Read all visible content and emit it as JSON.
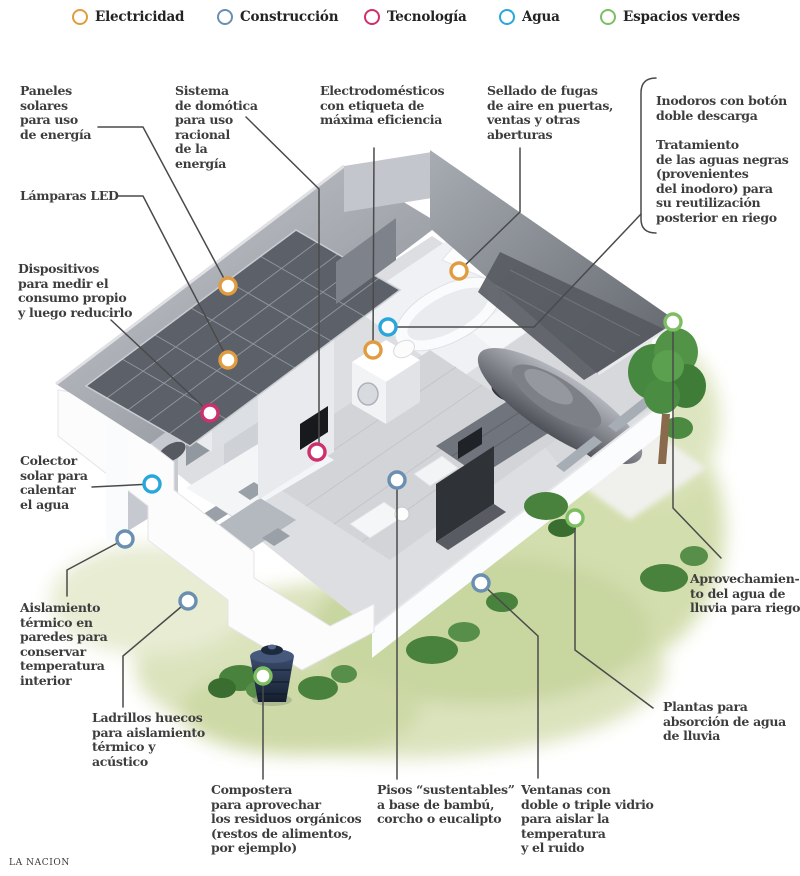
{
  "page": {
    "background": "#ffffff",
    "leader_color": "#4a4a4a",
    "text_color": "#3d3d3d"
  },
  "legend": {
    "items": [
      {
        "id": "electricidad",
        "label": "Electricidad",
        "color": "#E09C3F"
      },
      {
        "id": "construccion",
        "label": "Construcción",
        "color": "#6A8FB0"
      },
      {
        "id": "tecnologia",
        "label": "Tecnología",
        "color": "#CE2F6D"
      },
      {
        "id": "agua",
        "label": "Agua",
        "color": "#29A7DB"
      },
      {
        "id": "espacios_verdes",
        "label": "Espacios verdes",
        "color": "#7DBE63"
      }
    ]
  },
  "callouts": {
    "paneles_solares": {
      "category": "electricidad",
      "text": "Paneles\nsolares\npara uso\nde energía"
    },
    "sistema_domotica": {
      "category": "tecnologia",
      "text": "Sistema\nde domótica\npara uso\nracional\nde la\nenergía"
    },
    "electrodomesticos": {
      "category": "electricidad",
      "text": "Electrodomésticos\ncon etiqueta de\nmáxima eficiencia"
    },
    "sellado_fugas": {
      "category": "electricidad",
      "text": "Sellado de fugas\nde aire en puertas,\nventas y otras\naberturas"
    },
    "inodoros": {
      "category": "agua",
      "text": "Inodoros con botón\ndoble descarga"
    },
    "tratamiento": {
      "category": "agua",
      "text": "Tratamiento\nde las aguas negras\n(provenientes\ndel inodoro) para\nsu reutilización\nposterior en riego"
    },
    "lamparas_led": {
      "category": "electricidad",
      "text": "Lámparas LED"
    },
    "dispositivos": {
      "category": "tecnologia",
      "text": "Dispositivos\npara medir el\nconsumo propio\ny luego reducirlo"
    },
    "colector_solar": {
      "category": "agua",
      "text": "Colector\nsolar para\ncalentar\nel agua"
    },
    "aislamiento": {
      "category": "construccion",
      "text": "Aislamiento\ntérmico en\nparedes para\nconservar\ntemperatura\ninterior"
    },
    "ladrillos": {
      "category": "construccion",
      "text": "Ladrillos huecos\npara aislamiento\ntérmico y\nacústico"
    },
    "compostera": {
      "category": "espacios_verdes",
      "text": "Compostera\npara aprovechar\nlos residuos orgánicos\n(restos de alimentos,\npor ejemplo)"
    },
    "pisos": {
      "category": "construccion",
      "text": "Pisos “sustentables”\na base de bambú,\ncorcho o eucalipto"
    },
    "ventanas": {
      "category": "construccion",
      "text": "Ventanas con\ndoble o triple vidrio\npara aislar la\ntemperatura\ny el ruido"
    },
    "aprovechamiento": {
      "category": "espacios_verdes",
      "text": "Aprovechamien-\nto del agua de\nlluvia para riego"
    },
    "plantas": {
      "category": "espacios_verdes",
      "text": "Plantas para\nabsorción de agua\nde lluvia"
    }
  },
  "markers": [
    {
      "id": "paneles-solares",
      "category": "electricidad",
      "x": 228,
      "y": 286
    },
    {
      "id": "lamparas-led",
      "category": "electricidad",
      "x": 228,
      "y": 360
    },
    {
      "id": "electrodomesticos",
      "category": "electricidad",
      "x": 373,
      "y": 350
    },
    {
      "id": "sellado-fugas",
      "category": "electricidad",
      "x": 459,
      "y": 271
    },
    {
      "id": "dispositivos-consumo",
      "category": "tecnologia",
      "x": 210,
      "y": 413
    },
    {
      "id": "sistema-domotica",
      "category": "tecnologia",
      "x": 317,
      "y": 452
    },
    {
      "id": "colector-solar",
      "category": "agua",
      "x": 152,
      "y": 484
    },
    {
      "id": "inodoros-tratamiento",
      "category": "agua",
      "x": 388,
      "y": 327
    },
    {
      "id": "aislamiento-termico",
      "category": "construccion",
      "x": 125,
      "y": 539
    },
    {
      "id": "ladrillos-huecos",
      "category": "construccion",
      "x": 188,
      "y": 601
    },
    {
      "id": "pisos-sustentables",
      "category": "construccion",
      "x": 397,
      "y": 480
    },
    {
      "id": "ventanas-vidrio",
      "category": "construccion",
      "x": 481,
      "y": 583
    },
    {
      "id": "compostera",
      "category": "espacios_verdes",
      "x": 263,
      "y": 676
    },
    {
      "id": "plantas-absorcion",
      "category": "espacios_verdes",
      "x": 575,
      "y": 518
    },
    {
      "id": "aprovechamiento-lluvia",
      "category": "espacios_verdes",
      "x": 673,
      "y": 322
    }
  ],
  "footer": {
    "credit": "LA NACION"
  }
}
